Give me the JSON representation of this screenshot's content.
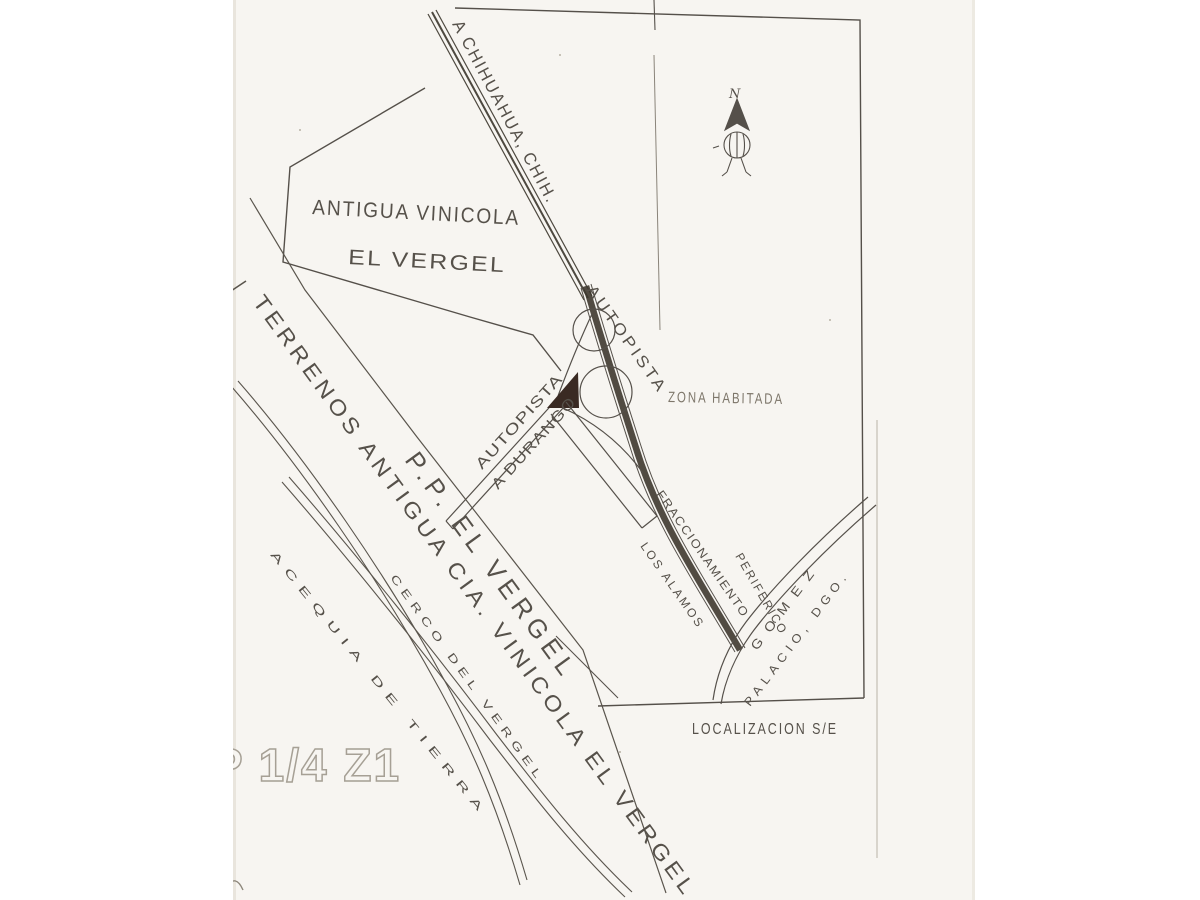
{
  "page": {
    "paper_color": "#f7f5f1",
    "ink_color": "#56514a",
    "faded_ink_color": "#7e776b",
    "marker_color": "#3a2a23"
  },
  "labels": {
    "to_chihuahua": "A CHIHUAHUA, CHIH.",
    "vinicola_line1": "ANTIGUA VINICOLA",
    "vinicola_line2": "EL VERGEL",
    "autopista": "AUTOPISTA",
    "autopista_durango_line1": "AUTOPISTA",
    "autopista_durango_line2": "A DURANGO",
    "zona_habitada": "ZONA HABITADA",
    "fraccionamiento_line1": "FRACCIONAMIENTO",
    "fraccionamiento_line2": "LOS ALAMOS",
    "periferico": "PERIFERICO",
    "gomez_line1": "GOMEZ",
    "gomez_line2": "PALACIO, DGO.",
    "terrenos": "TERRENOS ANTIGUA CIA. VINICOLA EL VERGEL",
    "pp_el_vergel": "P.P. EL VERGEL",
    "acequia": "ACEQUIA DE TIERRA",
    "cerco": "CERCO DEL VERGEL",
    "localizacion": "LOCALIZACION S/E",
    "sheet_code": "P 1/4 Z1",
    "north": "N"
  }
}
